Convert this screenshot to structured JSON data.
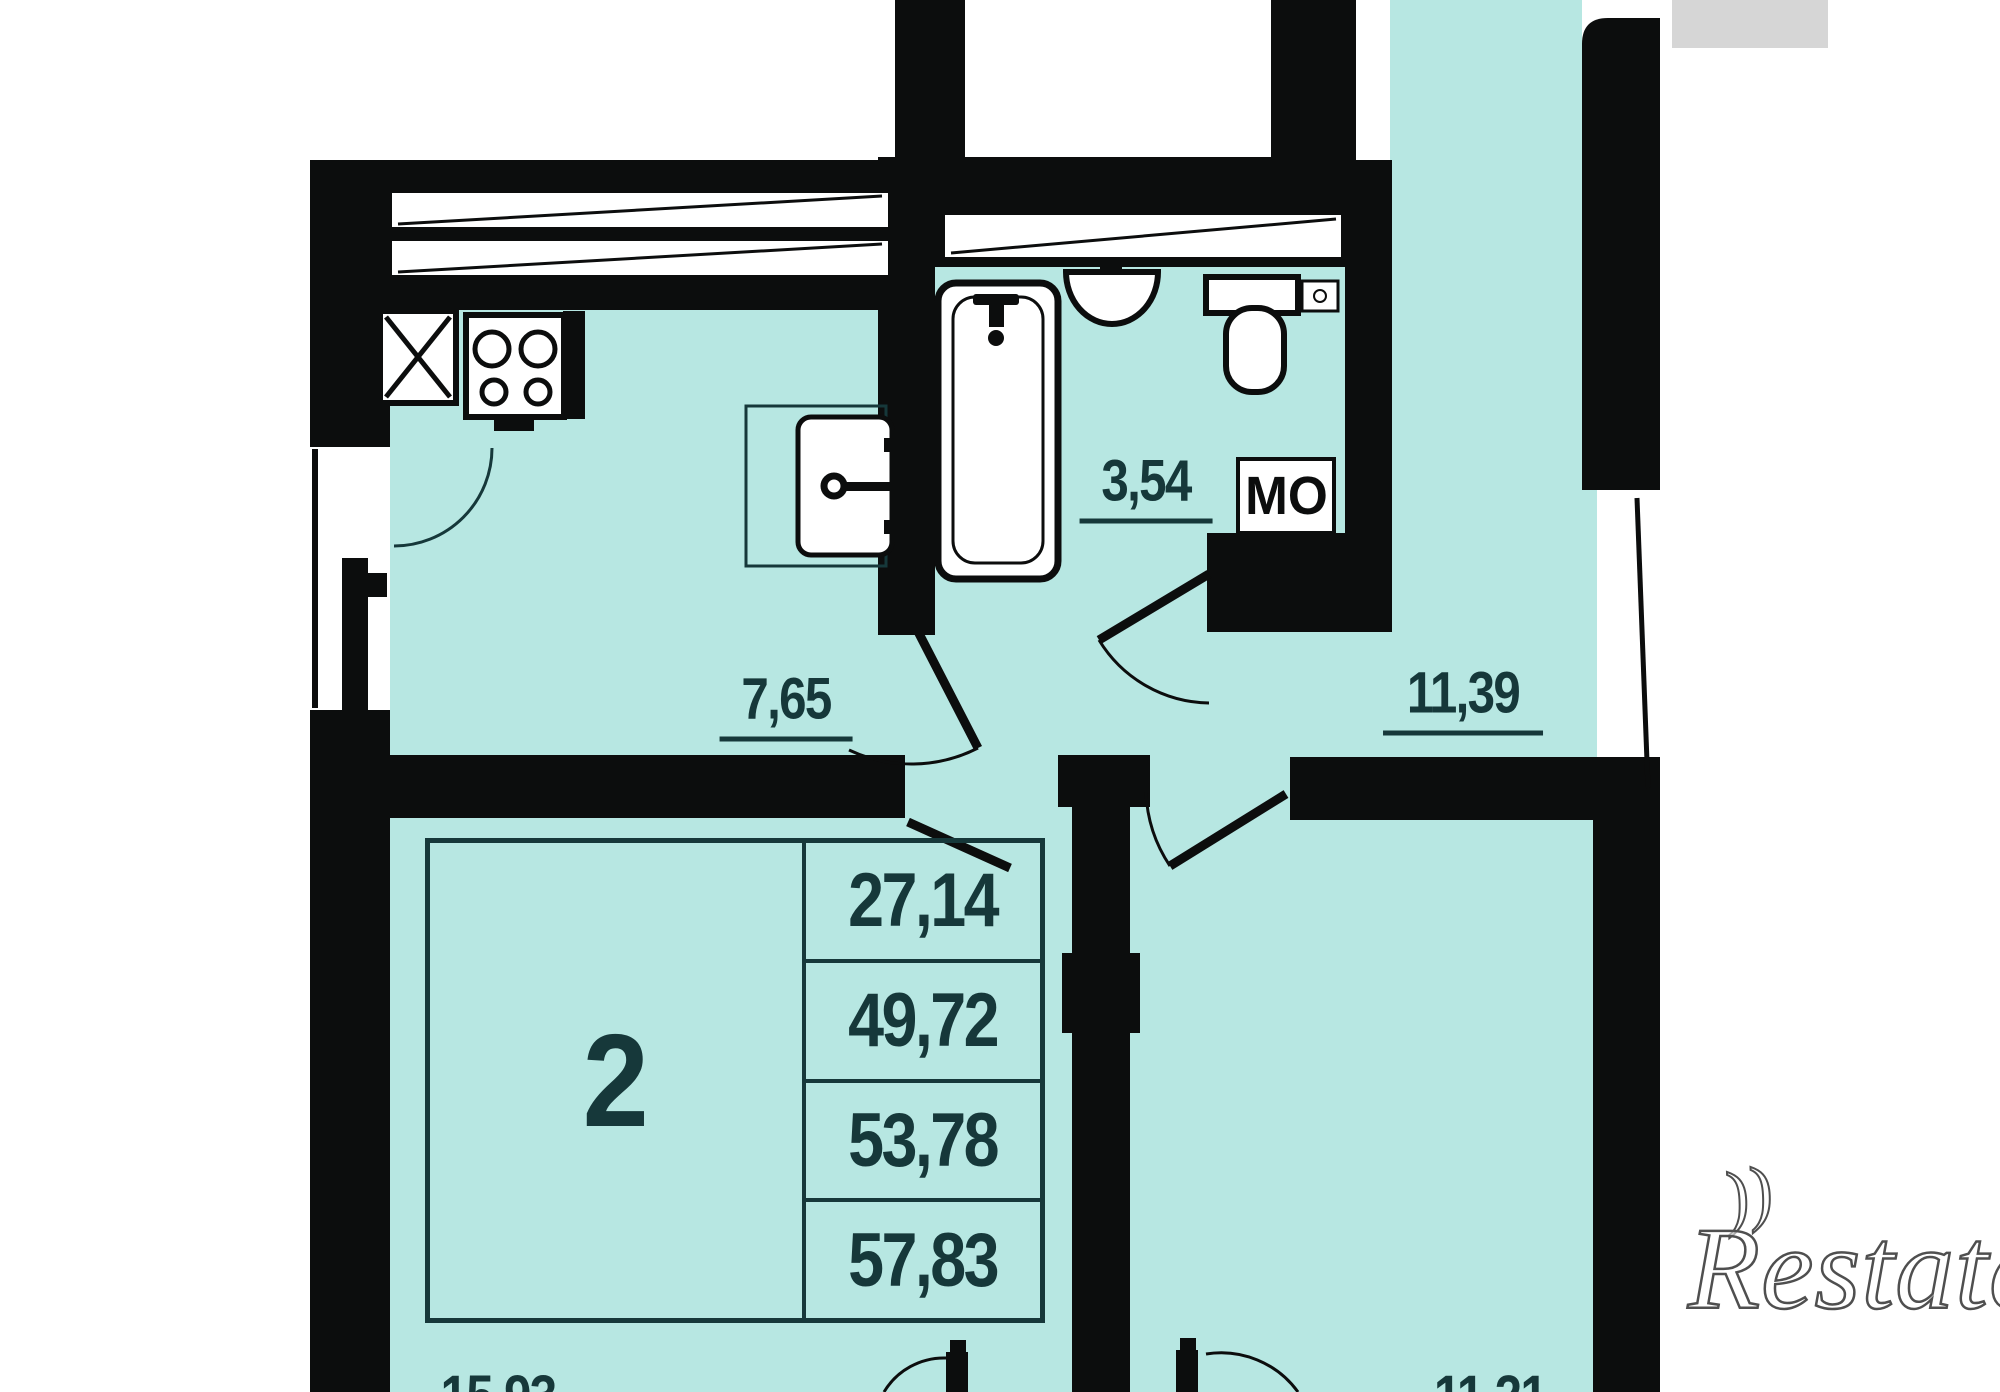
{
  "plan_type": "apartment-floor-plan",
  "stamp": {
    "room_count": "2",
    "areas": [
      "27,14",
      "49,72",
      "53,78",
      "57,83"
    ]
  },
  "areas": {
    "kitchen": "7,65",
    "bathroom": "3,54",
    "hallway": "11,39",
    "living_room": "15,93",
    "bedroom": "11,21"
  },
  "annotations": {
    "common_area": "МО"
  },
  "watermark": {
    "text": "Restate",
    "swash": "))"
  },
  "colors": {
    "floor": "#b7e7e2",
    "wall": "#0c0d0d",
    "ink": "#16383a",
    "neighbor_gray": "#d6d6d6",
    "watermark_outline": "#4f4f4f"
  }
}
